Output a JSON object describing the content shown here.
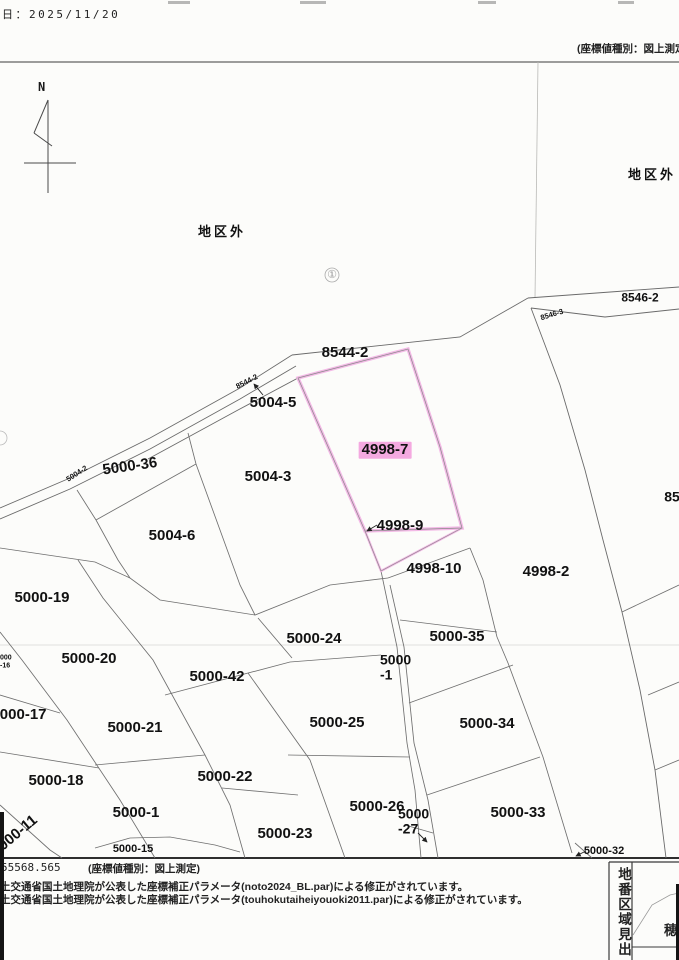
{
  "header": {
    "date": "日：2025/11/20",
    "coord_type_note": "(座標値種別：図上測定"
  },
  "compass": {
    "north_label": "N"
  },
  "footer": {
    "coord_value": "55568.565",
    "coord_type_note": "(座標値種別：図上測定)",
    "corrections": [
      "土交通省国土地理院が公表した座標補正パラメータ(noto2024_BL.par)による修正がされています。",
      "土交通省国土地理院が公表した座標補正パラメータ(touhokutaiheiyouoki2011.par)による修正がされています。"
    ]
  },
  "index_box": {
    "title": "地番区域見出",
    "area_char": "穂"
  },
  "selected_parcel": "4998-7",
  "colors": {
    "highlight_pink": "#f4a9e0",
    "parcel_outline_pink": "#f3b9e6",
    "line_gray": "#6a6a6a",
    "paper": "#fcfcfa"
  },
  "map": {
    "labels": [
      {
        "t": "地区外",
        "x": 222,
        "y": 232,
        "s": 13,
        "ls": 3,
        "w": 600
      },
      {
        "t": "地区外",
        "x": 652,
        "y": 175,
        "s": 13,
        "ls": 3,
        "w": 600
      },
      {
        "t": "①",
        "x": 332,
        "y": 275,
        "s": 11,
        "c": "#999999",
        "w": 400
      },
      {
        "t": "8546-2",
        "x": 640,
        "y": 298,
        "s": 12
      },
      {
        "t": "8546-3",
        "x": 552,
        "y": 315,
        "s": 7.5,
        "r": -17
      },
      {
        "t": "8544-2",
        "x": 345,
        "y": 353,
        "s": 15
      },
      {
        "t": "8544-2",
        "x": 247,
        "y": 382,
        "s": 7.5,
        "r": -27
      },
      {
        "t": "5004-5",
        "x": 273,
        "y": 403,
        "s": 15
      },
      {
        "t": "5004-2",
        "x": 77,
        "y": 474,
        "s": 7.5,
        "r": -33
      },
      {
        "t": "5000-36",
        "x": 130,
        "y": 467,
        "s": 15,
        "r": -8
      },
      {
        "t": "5004-3",
        "x": 268,
        "y": 477,
        "s": 15
      },
      {
        "t": "4998-7",
        "x": 385,
        "y": 450,
        "s": 15,
        "hl": true
      },
      {
        "t": "85",
        "x": 672,
        "y": 497,
        "s": 14
      },
      {
        "t": "5004-6",
        "x": 172,
        "y": 536,
        "s": 15
      },
      {
        "t": "4998-9",
        "x": 400,
        "y": 526,
        "s": 15
      },
      {
        "t": "4998-10",
        "x": 434,
        "y": 569,
        "s": 15
      },
      {
        "t": "4998-2",
        "x": 546,
        "y": 572,
        "s": 15
      },
      {
        "t": "5000-19",
        "x": 42,
        "y": 598,
        "s": 15
      },
      {
        "t": "5000-24",
        "x": 314,
        "y": 639,
        "s": 15
      },
      {
        "t": "5000-35",
        "x": 457,
        "y": 637,
        "s": 15
      },
      {
        "t": "5000-20",
        "x": 89,
        "y": 659,
        "s": 15
      },
      {
        "t": "5000-42",
        "x": 217,
        "y": 677,
        "s": 15
      },
      {
        "lines": [
          "5000",
          "-1"
        ],
        "x": 380,
        "y": 668,
        "s": 14,
        "align": "left"
      },
      {
        "lines": [
          "000",
          "-16"
        ],
        "x": 0,
        "y": 662,
        "s": 7,
        "align": "left"
      },
      {
        "t": "5000-17",
        "x": 19,
        "y": 715,
        "s": 15
      },
      {
        "t": "5000-21",
        "x": 135,
        "y": 728,
        "s": 15
      },
      {
        "t": "5000-25",
        "x": 337,
        "y": 723,
        "s": 15
      },
      {
        "t": "5000-34",
        "x": 487,
        "y": 724,
        "s": 15
      },
      {
        "t": "5000-18",
        "x": 56,
        "y": 781,
        "s": 15
      },
      {
        "t": "5000-22",
        "x": 225,
        "y": 777,
        "s": 15
      },
      {
        "t": "5000-26",
        "x": 377,
        "y": 807,
        "s": 15
      },
      {
        "lines": [
          "5000",
          "-27"
        ],
        "x": 398,
        "y": 822,
        "s": 14,
        "align": "left"
      },
      {
        "t": "5000-33",
        "x": 518,
        "y": 813,
        "s": 15
      },
      {
        "t": "5000-23",
        "x": 285,
        "y": 834,
        "s": 15
      },
      {
        "t": "5000-1",
        "x": 136,
        "y": 813,
        "s": 15
      },
      {
        "t": "5000-11",
        "x": 15,
        "y": 836,
        "s": 15,
        "r": -40
      },
      {
        "t": "5000-15",
        "x": 133,
        "y": 849,
        "s": 11
      },
      {
        "t": "5000-32",
        "x": 604,
        "y": 851,
        "s": 11
      }
    ]
  }
}
